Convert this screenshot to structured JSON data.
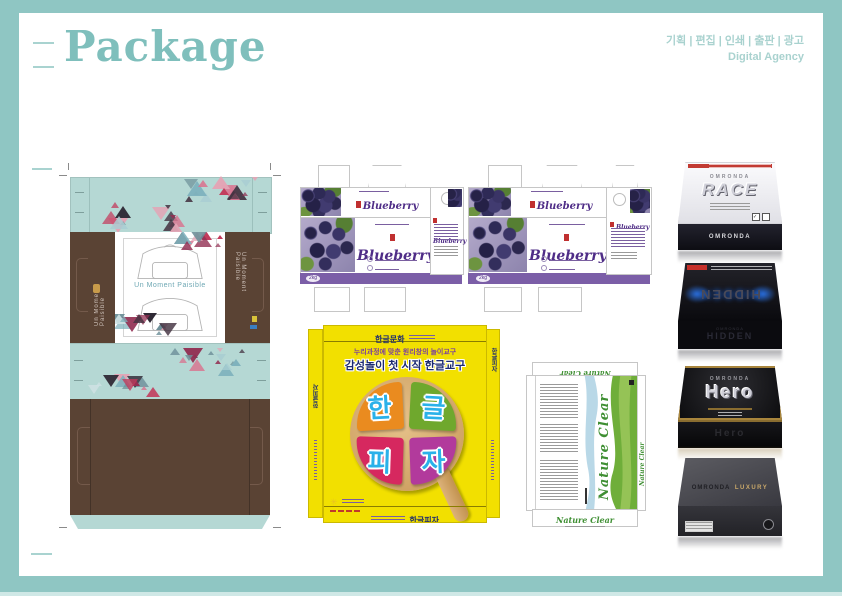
{
  "header": {
    "title": "Package",
    "services": "기획 | 편집 | 인쇄 | 출판 | 광고",
    "agency": "Digital Agency"
  },
  "furniture_pack": {
    "slogan": "Un Moment Paisible",
    "side_label": "Un Moment Paisible"
  },
  "blueberry_pack": {
    "brand": "Blueberry",
    "weight": "2kg"
  },
  "pizza_pack": {
    "header_brand": "한글문화",
    "tagline_top": "누리과정에 맞춘 원리창의 놀이교구",
    "tagline_main": "감성놀이 첫 시작 한글교구",
    "syllables": [
      "한",
      "글",
      "피",
      "자"
    ],
    "bottom_label": "한글피자",
    "side_label": "한글피자"
  },
  "nature_pack": {
    "brand": "Nature Clear"
  },
  "product_boxes": [
    {
      "brand": "OMRONDA",
      "name": "RACE"
    },
    {
      "brand": "OMRONDA",
      "name": "HIDDEN"
    },
    {
      "brand": "OMRONDA",
      "name": "Hero"
    },
    {
      "brand": "OMRONDA",
      "name": "LUXURY"
    }
  ],
  "colors": {
    "frame_teal": "#8fc6c3",
    "panel_teal": "#b5d8d4",
    "panel_brown": "#5a4334",
    "blueberry_purple": "#7b5ea7",
    "pizza_yellow": "#f2e000",
    "nature_green": "#3f8f33"
  }
}
